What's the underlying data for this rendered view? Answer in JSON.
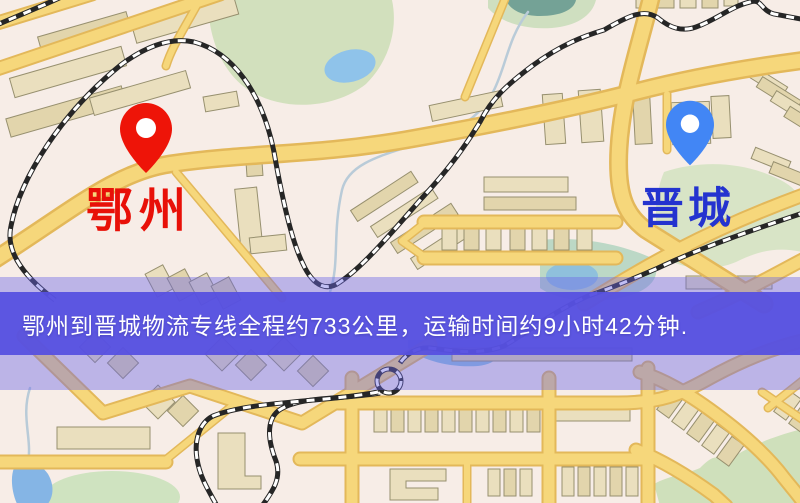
{
  "map": {
    "origin_label": "鄂州",
    "destination_label": "晋城",
    "origin_pin_color": "#ee1408",
    "origin_label_color": "#e81008",
    "destination_pin_color": "#4286f5",
    "destination_label_color": "#2433cf"
  },
  "banner": {
    "text": "鄂州到晋城物流专线全程约733公里，运输时间约9小时42分钟.",
    "background_color": "#5650e0",
    "text_color": "#ffffff"
  },
  "route": {
    "origin": "鄂州",
    "destination": "晋城",
    "distance_km": "733",
    "duration": "9小时42分钟"
  }
}
